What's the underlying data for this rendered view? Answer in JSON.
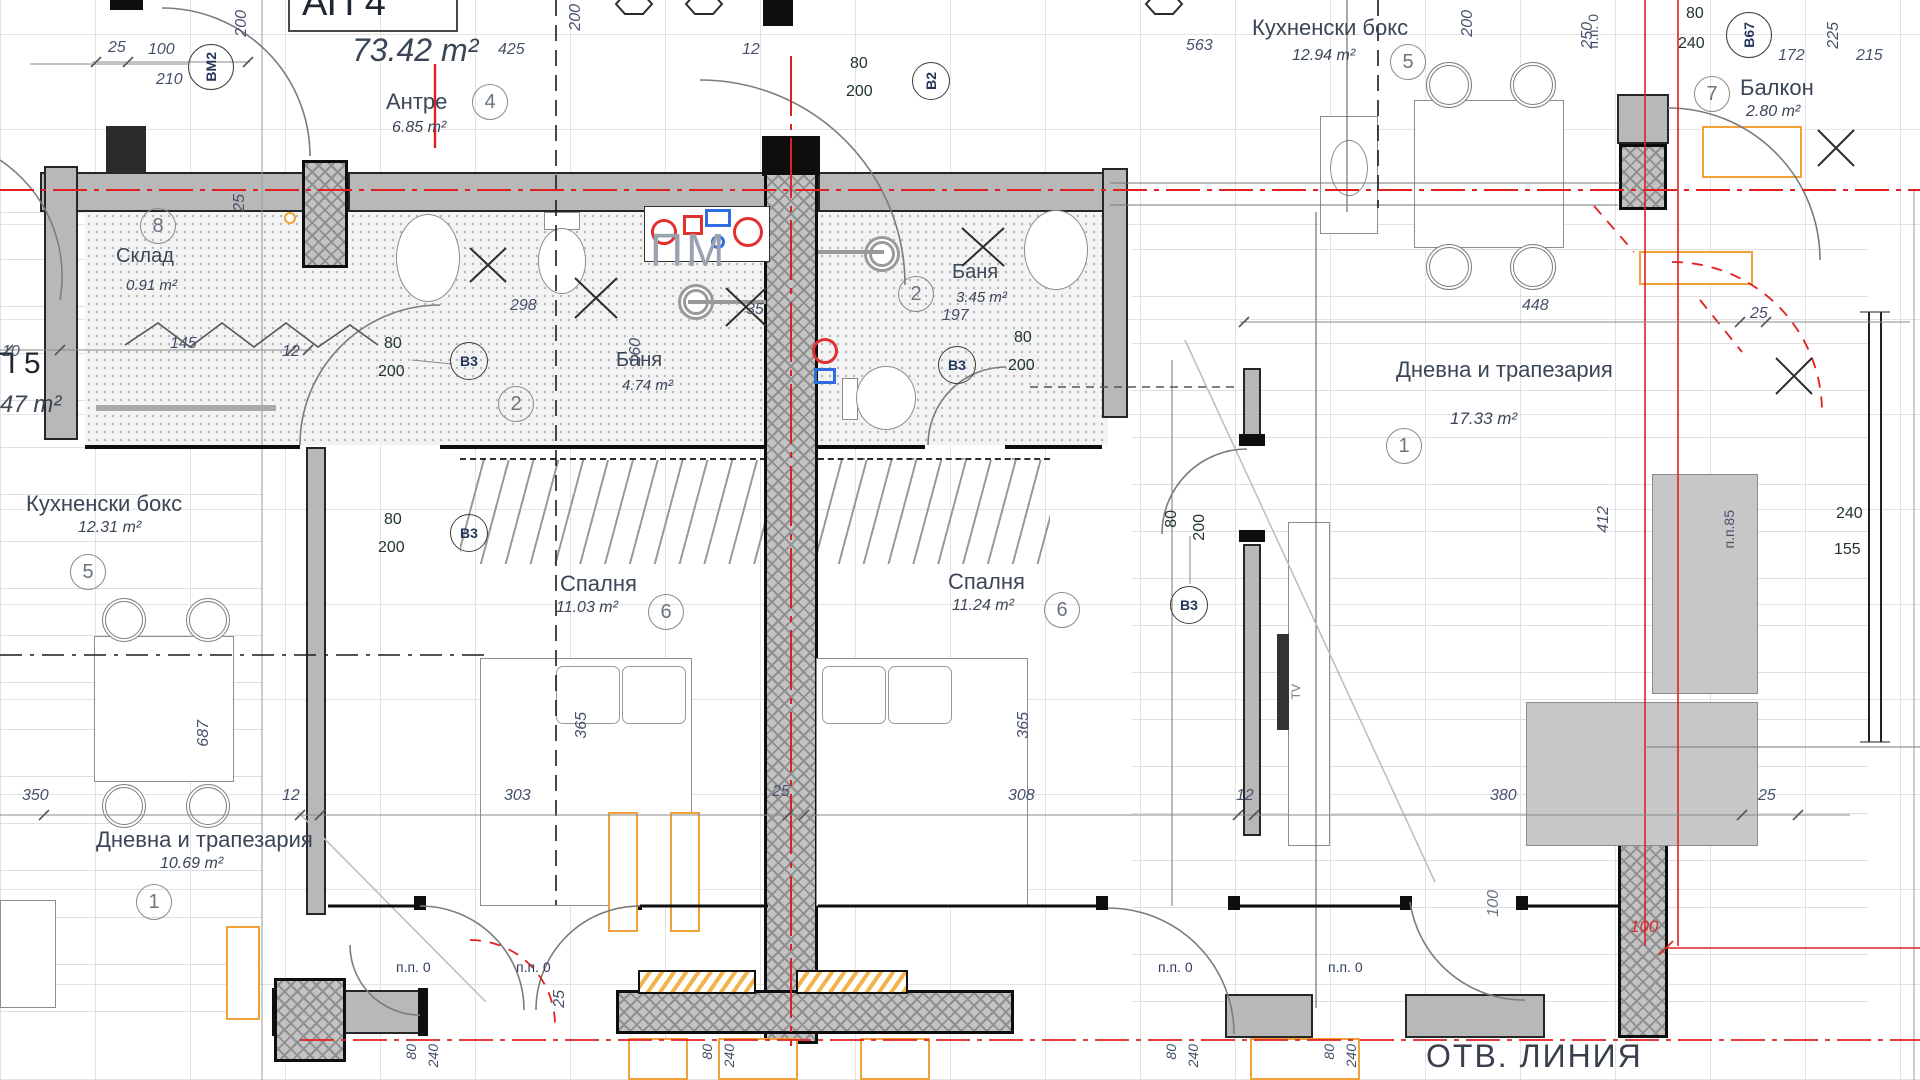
{
  "drawing": {
    "apartment": {
      "label": "АП 4",
      "area": "73.42 m²"
    },
    "adjacent_apartment": {
      "label": "П 5",
      "area": "47 m²"
    },
    "rooms": {
      "antre": {
        "name": "Антре",
        "area": "6.85 m²",
        "num": "4"
      },
      "sklad": {
        "name": "Склад",
        "area": "0.91 m²",
        "num": "8"
      },
      "banya_left": {
        "name": "Баня",
        "area": "4.74 m²",
        "num": "2"
      },
      "banya_right": {
        "name": "Баня",
        "area": "3.45 m²",
        "num": "2"
      },
      "kitchen_right": {
        "name": "Кухненски бокс",
        "area": "12.94 m²",
        "num": "5"
      },
      "kitchen_left": {
        "name": "Кухненски бокс",
        "area": "12.31 m²",
        "num": "5"
      },
      "balcony": {
        "name": "Балкон",
        "area": "2.80 m²",
        "num": "7"
      },
      "living_right": {
        "name": "Дневна и трапезария",
        "area": "17.33 m²",
        "num": "1"
      },
      "living_left": {
        "name": "Дневна и трапезария",
        "area": "10.69 m²",
        "num": "1"
      },
      "bedroom_left": {
        "name": "Спалня",
        "area": "11.03 m²",
        "num": "6"
      },
      "bedroom_right": {
        "name": "Спалня",
        "area": "11.24 m²",
        "num": "6"
      }
    },
    "markers": {
      "bm2": "ВМ2",
      "b2": "В2",
      "b3": "В3",
      "b67": "В67"
    },
    "labels": {
      "pm": "ПМ",
      "pp0": "п.п. 0",
      "pp85": "п.п.85",
      "tv": "TV",
      "otv": "ОТВ. ЛИНИЯ"
    },
    "dims": {
      "v10": "10",
      "v12": "12",
      "v25": "25",
      "v35": "35",
      "v80": "80",
      "v100": "100",
      "v145": "145",
      "v155": "155",
      "v160": "160",
      "v172": "172",
      "v197": "197",
      "v200": "200",
      "v210": "210",
      "v215": "215",
      "v225": "225",
      "v240": "240",
      "v250": "250",
      "v298": "298",
      "v303": "303",
      "v308": "308",
      "v350": "350",
      "v365": "365",
      "v380": "380",
      "v412": "412",
      "v425": "425",
      "v448": "448",
      "v563": "563",
      "v687": "687"
    },
    "colors": {
      "axis_red": "#e02020",
      "furniture_orange": "#f0a238",
      "wall_gray": "#b8b8b8",
      "text": "#3a4656"
    }
  }
}
